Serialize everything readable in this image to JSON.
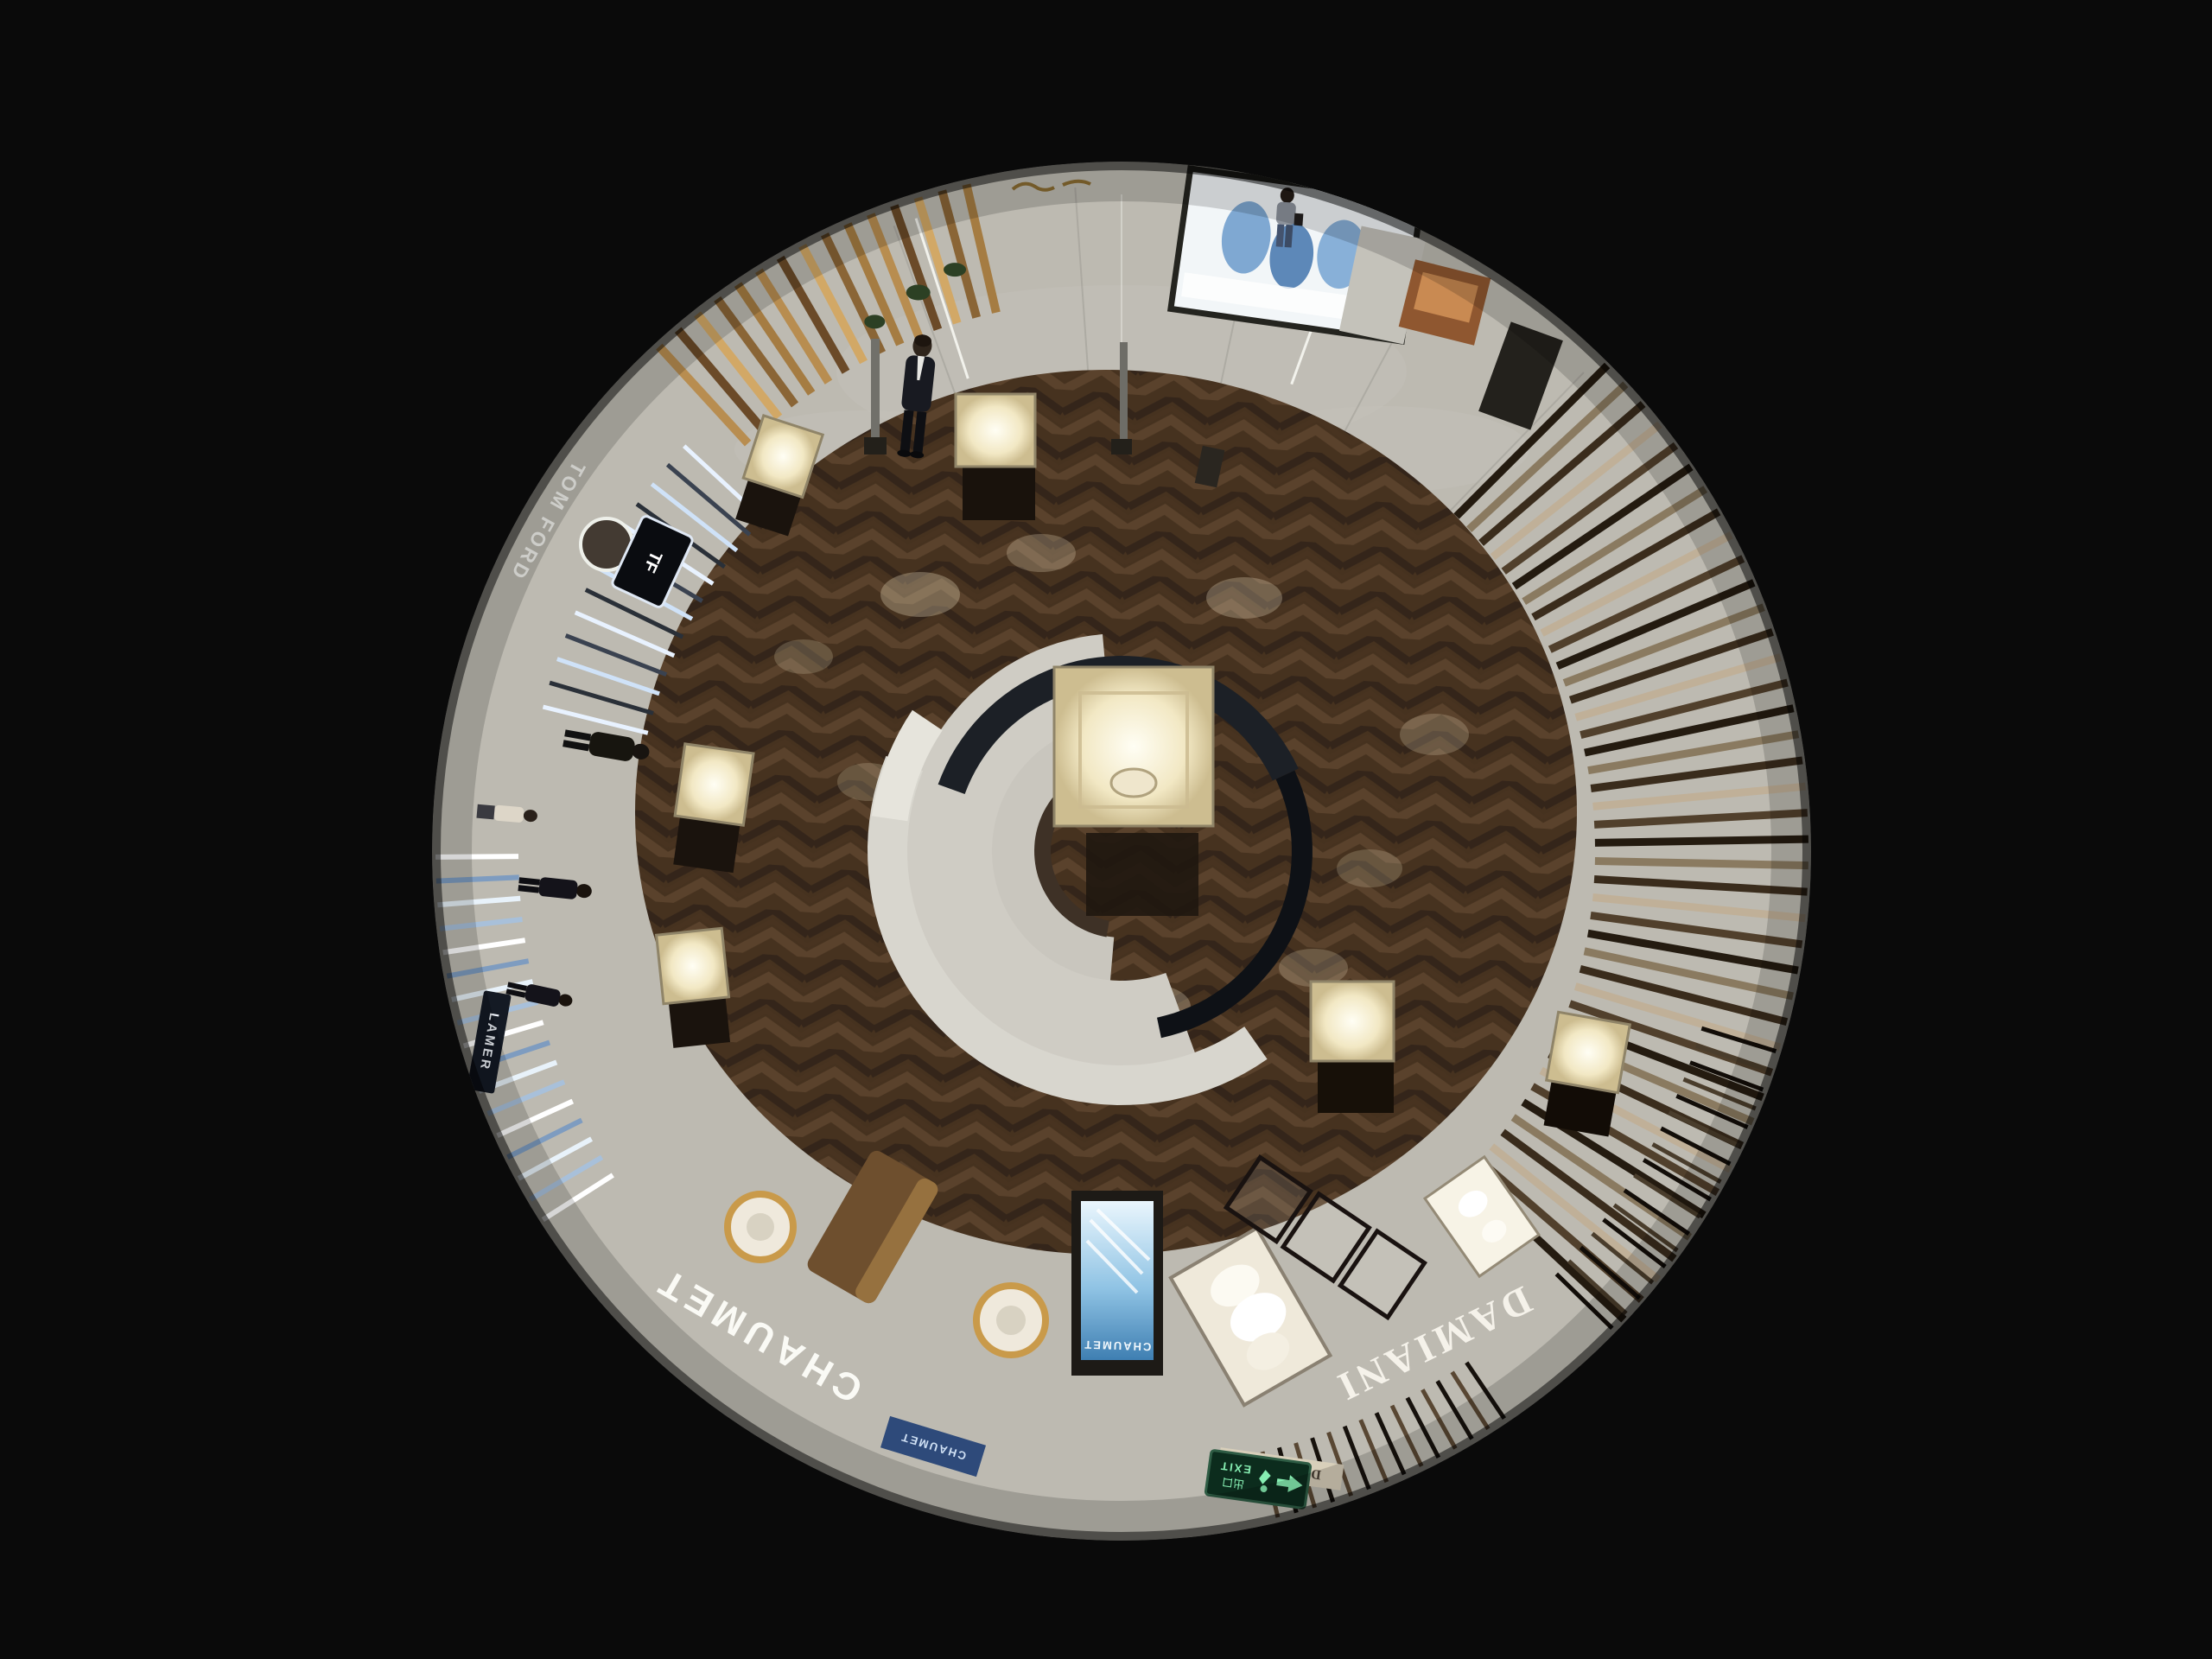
{
  "osd": {
    "timestamp": "09-29-2025 Mon 16:02:48",
    "camera_label": "Camera 01",
    "text_color": "#f1f1ee"
  },
  "feed": {
    "signs": {
      "tom_ford": "TOM FORD",
      "tf_monogram": "TF",
      "chaumet_fascia": "CHAUMET",
      "chaumet_screen": "CHAUMET",
      "chaumet_door": "CHAUMET",
      "damiani_fascia": "DAMIANI",
      "damiani_lintel": "DAMIANI",
      "la_mer": "LAMER",
      "exit_cn": "出口",
      "exit_en": "EXIT"
    },
    "colors": {
      "background": "#0a0a0a",
      "wood_floor": "#46321f",
      "marble": "#a9a79f",
      "ceiling": "#d8d6cf",
      "gold_kiosk": "#b88d50",
      "tomford_fascia": "#0e1116",
      "chaumet_fascia": "#20263a",
      "damiani_fascia": "#382f24",
      "screen_blue": "#8fc3e4",
      "exit_green": "#86eeb2",
      "case_glow": "#fffef4"
    }
  }
}
